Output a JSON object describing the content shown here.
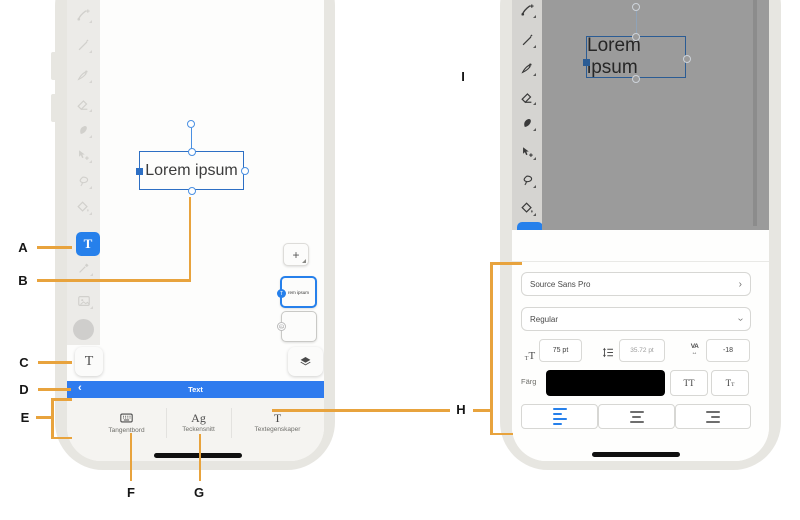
{
  "colors": {
    "accent_blue": "#2680EB",
    "callout_orange": "#E8A33D",
    "canvas_dim_gray": "#9B9B9B",
    "swatch_black": "#000000"
  },
  "callouts": {
    "a": "A",
    "b": "B",
    "c": "C",
    "d": "D",
    "e": "E",
    "f": "F",
    "g": "G",
    "h": "H",
    "i": "I"
  },
  "icons": {
    "back": "‹",
    "forward": "›",
    "add": "+",
    "toolbar": [
      "paint-brush",
      "pencil",
      "ink-pen",
      "eraser",
      "smudge",
      "move",
      "lasso",
      "fill"
    ]
  },
  "left_phone": {
    "type_tool_label": "T",
    "canvas": {
      "text": "Lorem ipsum"
    },
    "layers_flyout": {
      "layer1_text": "rem ipsum",
      "layer1_badge": "T"
    },
    "text_tool_chip": "T",
    "text_bar": {
      "title": "Text"
    },
    "actions": {
      "keyboard_label": "Tangentbord",
      "font_icon_glyph": "Ag",
      "font_label": "Teckensnitt",
      "props_icon_glyph": "T",
      "props_label": "Textegenskaper"
    }
  },
  "right_phone": {
    "canvas": {
      "text": "Lorem ipsum"
    },
    "text_properties": {
      "title": "Textegenskaper",
      "font_family": "Source Sans Pro",
      "font_style": "Regular",
      "size_icon_small": "T",
      "size_icon_big": "T",
      "size_value": "75 pt",
      "leading_value": "35.72 pt",
      "tracking_icon": "VA",
      "tracking_arrow": "↔",
      "tracking_value": "-18",
      "color_label": "Färg",
      "uppercase_button": "TT",
      "position_big": "T",
      "position_small": "T"
    }
  }
}
